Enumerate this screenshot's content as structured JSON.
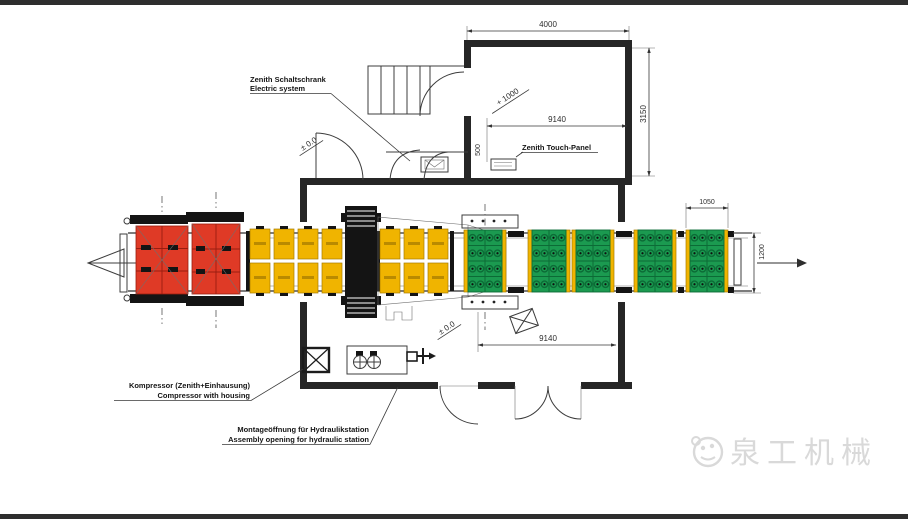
{
  "colors": {
    "bg": "#ffffff",
    "bar": "#2e2e2e",
    "line": "#3c3c3c",
    "wall": "#262626",
    "red": "#df3a26",
    "red_dark": "#991d10",
    "yellow": "#f0b400",
    "yellow_dark": "#a87d00",
    "green": "#1b9a50",
    "green_dark": "#0c6b36",
    "black_part": "#141414",
    "watermark": "#d9d9d9"
  },
  "annotations": {
    "electric_cabinet": {
      "line1": "Zenith Schaltschrank",
      "line2": "Electric system"
    },
    "touch_panel": {
      "label": "Zenith Touch-Panel"
    },
    "compressor": {
      "line1": "Kompressor (Zenith+Einhausung)",
      "line2": "Compressor with housing"
    },
    "assembly_opening": {
      "line1": "Montageöffnung für Hydraulikstation",
      "line2": "Assembly opening for hydraulic station"
    },
    "level_floor_top": "± 0.0",
    "level_floor_bottom": "± 0.0",
    "level_room": "+ 1000"
  },
  "dimensions": {
    "room_width": "4000",
    "room_depth": "3150",
    "panel_offset": "500",
    "hall_length_top": "9140",
    "hall_length_bottom": "9140",
    "pallet_width": "1050",
    "conveyor_width": "1200"
  },
  "watermark": {
    "brand": "泉工机械"
  }
}
